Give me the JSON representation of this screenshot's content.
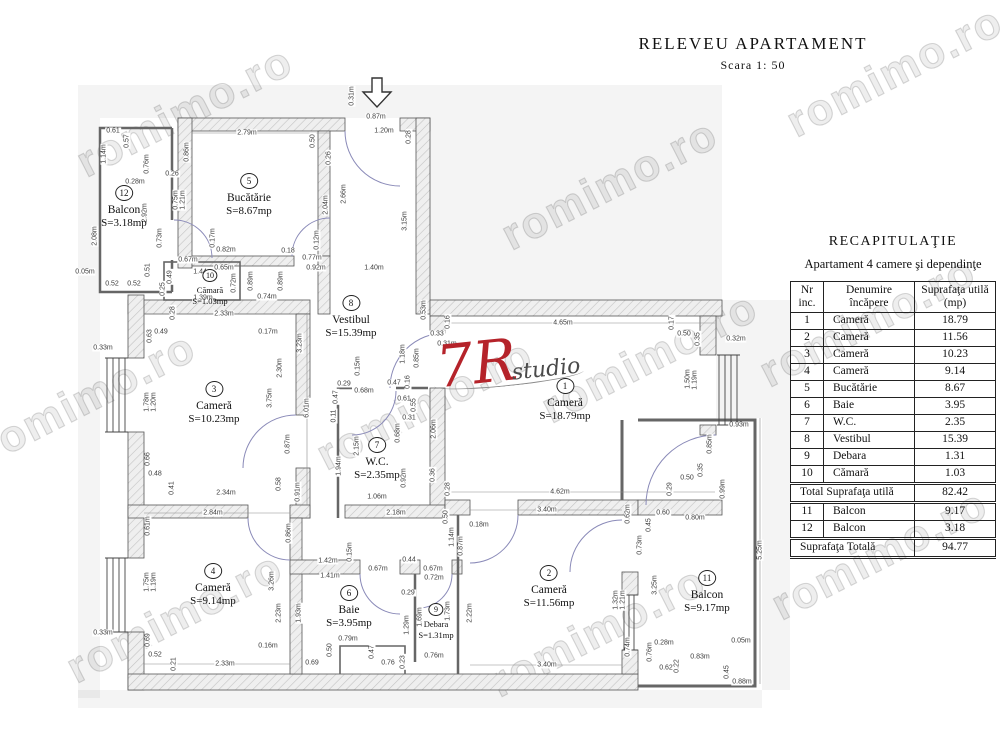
{
  "title": {
    "main": "RELEVEU  APARTAMENT",
    "scale": "Scara  1: 50"
  },
  "logo": {
    "mark": "7R",
    "word": "studio"
  },
  "watermark": {
    "text": "romimo.ro",
    "positions": [
      [
        185,
        112
      ],
      [
        610,
        185
      ],
      [
        895,
        72
      ],
      [
        88,
        398
      ],
      [
        425,
        405
      ],
      [
        650,
        358
      ],
      [
        175,
        618
      ],
      [
        598,
        632
      ],
      [
        880,
        555
      ],
      [
        868,
        322
      ]
    ]
  },
  "recap": {
    "title": "RECAPITULAŢIE",
    "subtitle": "Apartament 4 camere şi dependinţe",
    "columns": [
      "Nr inc.",
      "Denumire încăpere",
      "Suprafaţa utilă (mp)"
    ],
    "rows": [
      {
        "nr": "1",
        "name": "Cameră",
        "area": "18.79"
      },
      {
        "nr": "2",
        "name": "Cameră",
        "area": "11.56"
      },
      {
        "nr": "3",
        "name": "Cameră",
        "area": "10.23"
      },
      {
        "nr": "4",
        "name": "Cameră",
        "area": "9.14"
      },
      {
        "nr": "5",
        "name": "Bucătărie",
        "area": "8.67"
      },
      {
        "nr": "6",
        "name": "Baie",
        "area": "3.95"
      },
      {
        "nr": "7",
        "name": "W.C.",
        "area": "2.35"
      },
      {
        "nr": "8",
        "name": "Vestibul",
        "area": "15.39"
      },
      {
        "nr": "9",
        "name": "Debara",
        "area": "1.31"
      },
      {
        "nr": "10",
        "name": "Cămară",
        "area": "1.03"
      }
    ],
    "total_label": "Total Suprafaţa utilă",
    "total_value": "82.42",
    "balcony_rows": [
      {
        "nr": "11",
        "name": "Balcon",
        "area": "9.17"
      },
      {
        "nr": "12",
        "name": "Balcon",
        "area": "3.18"
      }
    ],
    "grand_label": "Suprafaţa  Totală",
    "grand_value": "94.77"
  },
  "plan": {
    "rooms": [
      {
        "nr": "1",
        "name": "Cameră",
        "area": "S=18.79mp",
        "x": 565,
        "y": 383
      },
      {
        "nr": "2",
        "name": "Cameră",
        "area": "S=11.56mp",
        "x": 549,
        "y": 570
      },
      {
        "nr": "3",
        "name": "Cameră",
        "area": "S=10.23mp",
        "x": 214,
        "y": 386
      },
      {
        "nr": "4",
        "name": "Cameră",
        "area": "S=9.14mp",
        "x": 213,
        "y": 568
      },
      {
        "nr": "5",
        "name": "Bucătărie",
        "area": "S=8.67mp",
        "x": 249,
        "y": 178
      },
      {
        "nr": "6",
        "name": "Baie",
        "area": "S=3.95mp",
        "x": 349,
        "y": 590
      },
      {
        "nr": "7",
        "name": "W.C.",
        "area": "S=2.35mp",
        "x": 377,
        "y": 442
      },
      {
        "nr": "8",
        "name": "Vestibul",
        "area": "S=15.39mp",
        "x": 351,
        "y": 300
      },
      {
        "nr": "9",
        "name": "Debara",
        "area": "S=1.31mp",
        "x": 436,
        "y": 606,
        "s": true
      },
      {
        "nr": "10",
        "name": "Cămară",
        "area": "S=1.03mp",
        "x": 210,
        "y": 272,
        "s": true
      },
      {
        "nr": "11",
        "name": "Balcon",
        "area": "S=9.17mp",
        "x": 707,
        "y": 575
      },
      {
        "nr": "12",
        "name": "Balcon",
        "area": "S=3.18mp",
        "x": 124,
        "y": 190
      }
    ],
    "dimensions": [
      {
        "t": "0.31m",
        "x": 352,
        "y": 96,
        "r": 90
      },
      {
        "t": "0.87m",
        "x": 376,
        "y": 117,
        "r": 0
      },
      {
        "t": "1.20m",
        "x": 384,
        "y": 131,
        "r": 0
      },
      {
        "t": "0.28",
        "x": 409,
        "y": 137,
        "r": 90
      },
      {
        "t": "2.79m",
        "x": 247,
        "y": 133,
        "r": 0
      },
      {
        "t": "0.50",
        "x": 313,
        "y": 141,
        "r": 90
      },
      {
        "t": "0.26",
        "x": 329,
        "y": 158,
        "r": 90
      },
      {
        "t": "0.86m",
        "x": 187,
        "y": 152,
        "r": 90
      },
      {
        "t": "0.61",
        "x": 113,
        "y": 131,
        "r": 0
      },
      {
        "t": "0.57",
        "x": 127,
        "y": 141,
        "r": 90
      },
      {
        "t": "1.14m",
        "x": 104,
        "y": 154,
        "r": 90
      },
      {
        "t": "0.76m",
        "x": 147,
        "y": 164,
        "r": 90
      },
      {
        "t": "0.28m",
        "x": 135,
        "y": 182,
        "r": 0
      },
      {
        "t": "0.26",
        "x": 172,
        "y": 174,
        "r": 0
      },
      {
        "t": "2.92m",
        "x": 145,
        "y": 213,
        "r": 90
      },
      {
        "t": "0.75m",
        "x": 176,
        "y": 200,
        "r": 90
      },
      {
        "t": "1.21m",
        "x": 183,
        "y": 200,
        "r": 90
      },
      {
        "t": "2.66m",
        "x": 344,
        "y": 194,
        "r": 90
      },
      {
        "t": "2.04m",
        "x": 326,
        "y": 205,
        "r": 90
      },
      {
        "t": "3.15m",
        "x": 405,
        "y": 221,
        "r": 90
      },
      {
        "t": "0.12m",
        "x": 317,
        "y": 240,
        "r": 90
      },
      {
        "t": "0.17m",
        "x": 213,
        "y": 238,
        "r": 90
      },
      {
        "t": "0.82m",
        "x": 226,
        "y": 250,
        "r": 0
      },
      {
        "t": "0.18",
        "x": 288,
        "y": 251,
        "r": 0
      },
      {
        "t": "0.77m",
        "x": 312,
        "y": 258,
        "r": 0
      },
      {
        "t": "0.92m",
        "x": 316,
        "y": 268,
        "r": 0
      },
      {
        "t": "0.67m",
        "x": 188,
        "y": 260,
        "r": 0
      },
      {
        "t": "1.44m",
        "x": 203,
        "y": 272,
        "r": 0
      },
      {
        "t": "0.65m",
        "x": 224,
        "y": 268,
        "r": 0
      },
      {
        "t": "0.49",
        "x": 170,
        "y": 277,
        "r": 90
      },
      {
        "t": "0.25",
        "x": 163,
        "y": 289,
        "r": 90
      },
      {
        "t": "0.72m",
        "x": 234,
        "y": 283,
        "r": 90
      },
      {
        "t": "0.89m",
        "x": 251,
        "y": 281,
        "r": 90
      },
      {
        "t": "0.89m",
        "x": 281,
        "y": 281,
        "r": 90
      },
      {
        "t": "1.39m",
        "x": 203,
        "y": 298,
        "r": 0
      },
      {
        "t": "0.74m",
        "x": 267,
        "y": 297,
        "r": 0
      },
      {
        "t": "2.08m",
        "x": 95,
        "y": 236,
        "r": 90
      },
      {
        "t": "0.73m",
        "x": 160,
        "y": 238,
        "r": 90
      },
      {
        "t": "0.51",
        "x": 148,
        "y": 270,
        "r": 90
      },
      {
        "t": "0.52",
        "x": 112,
        "y": 284,
        "r": 0
      },
      {
        "t": "0.52",
        "x": 134,
        "y": 284,
        "r": 0
      },
      {
        "t": "0.05m",
        "x": 85,
        "y": 272,
        "r": 0
      },
      {
        "t": "1.40m",
        "x": 374,
        "y": 268,
        "r": 0
      },
      {
        "t": "0.53m",
        "x": 424,
        "y": 310,
        "r": 90
      },
      {
        "t": "0.15m",
        "x": 358,
        "y": 366,
        "r": 90
      },
      {
        "t": "1.18m",
        "x": 403,
        "y": 354,
        "r": 90
      },
      {
        "t": "0.85m",
        "x": 417,
        "y": 358,
        "r": 90
      },
      {
        "t": "0.29",
        "x": 344,
        "y": 384,
        "r": 0
      },
      {
        "t": "0.47",
        "x": 336,
        "y": 397,
        "r": 90
      },
      {
        "t": "0.68m",
        "x": 364,
        "y": 391,
        "r": 0
      },
      {
        "t": "0.47",
        "x": 394,
        "y": 383,
        "r": 0
      },
      {
        "t": "0.16",
        "x": 408,
        "y": 382,
        "r": 90
      },
      {
        "t": "0.61",
        "x": 404,
        "y": 399,
        "r": 0
      },
      {
        "t": "0.55",
        "x": 414,
        "y": 405,
        "r": 90
      },
      {
        "t": "0.31",
        "x": 409,
        "y": 418,
        "r": 0
      },
      {
        "t": "0.11",
        "x": 334,
        "y": 416,
        "r": 90
      },
      {
        "t": "2.15m",
        "x": 357,
        "y": 446,
        "r": 90
      },
      {
        "t": "1.94m",
        "x": 339,
        "y": 466,
        "r": 90
      },
      {
        "t": "0.68m",
        "x": 398,
        "y": 433,
        "r": 90
      },
      {
        "t": "0.92m",
        "x": 404,
        "y": 478,
        "r": 90
      },
      {
        "t": "1.06m",
        "x": 377,
        "y": 497,
        "r": 0
      },
      {
        "t": "2.18m",
        "x": 396,
        "y": 513,
        "r": 0
      },
      {
        "t": "0.33",
        "x": 437,
        "y": 334,
        "r": 0
      },
      {
        "t": "0.31m",
        "x": 447,
        "y": 344,
        "r": 0
      },
      {
        "t": "2.06m",
        "x": 434,
        "y": 429,
        "r": 90
      },
      {
        "t": "0.36",
        "x": 433,
        "y": 475,
        "r": 90
      },
      {
        "t": "0.28",
        "x": 448,
        "y": 489,
        "r": 90
      },
      {
        "t": "0.33m",
        "x": 103,
        "y": 348,
        "r": 0
      },
      {
        "t": "0.63",
        "x": 150,
        "y": 336,
        "r": 90
      },
      {
        "t": "0.49",
        "x": 161,
        "y": 332,
        "r": 0
      },
      {
        "t": "0.28",
        "x": 173,
        "y": 313,
        "r": 90
      },
      {
        "t": "2.33m",
        "x": 224,
        "y": 314,
        "r": 0
      },
      {
        "t": "0.17m",
        "x": 268,
        "y": 332,
        "r": 0
      },
      {
        "t": "3.23m",
        "x": 300,
        "y": 343,
        "r": 90
      },
      {
        "t": "2.30m",
        "x": 280,
        "y": 368,
        "r": 90
      },
      {
        "t": "3.75m",
        "x": 270,
        "y": 398,
        "r": 90
      },
      {
        "t": "6.01m",
        "x": 307,
        "y": 408,
        "r": 90
      },
      {
        "t": "1.78m",
        "x": 147,
        "y": 402,
        "r": 90
      },
      {
        "t": "1.20m",
        "x": 154,
        "y": 402,
        "r": 90
      },
      {
        "t": "0.66",
        "x": 148,
        "y": 459,
        "r": 90
      },
      {
        "t": "0.48",
        "x": 155,
        "y": 474,
        "r": 0
      },
      {
        "t": "0.41",
        "x": 172,
        "y": 488,
        "r": 90
      },
      {
        "t": "2.34m",
        "x": 226,
        "y": 493,
        "r": 0
      },
      {
        "t": "0.58",
        "x": 279,
        "y": 484,
        "r": 90
      },
      {
        "t": "0.87m",
        "x": 288,
        "y": 444,
        "r": 90
      },
      {
        "t": "0.91m",
        "x": 298,
        "y": 492,
        "r": 90
      },
      {
        "t": "4.65m",
        "x": 563,
        "y": 323,
        "r": 0
      },
      {
        "t": "0.16",
        "x": 448,
        "y": 322,
        "r": 90
      },
      {
        "t": "0.17",
        "x": 672,
        "y": 323,
        "r": 90
      },
      {
        "t": "0.50",
        "x": 684,
        "y": 334,
        "r": 0
      },
      {
        "t": "0.35",
        "x": 698,
        "y": 339,
        "r": 90
      },
      {
        "t": "0.32m",
        "x": 736,
        "y": 339,
        "r": 0
      },
      {
        "t": "1.50m",
        "x": 688,
        "y": 379,
        "r": 90
      },
      {
        "t": "1.19m",
        "x": 695,
        "y": 380,
        "r": 90
      },
      {
        "t": "0.93m",
        "x": 739,
        "y": 425,
        "r": 0
      },
      {
        "t": "0.85m",
        "x": 710,
        "y": 444,
        "r": 90
      },
      {
        "t": "0.50",
        "x": 687,
        "y": 478,
        "r": 0
      },
      {
        "t": "0.35",
        "x": 701,
        "y": 470,
        "r": 90
      },
      {
        "t": "0.99m",
        "x": 723,
        "y": 489,
        "r": 90
      },
      {
        "t": "4.62m",
        "x": 560,
        "y": 492,
        "r": 0
      },
      {
        "t": "0.29",
        "x": 670,
        "y": 489,
        "r": 90
      },
      {
        "t": "2.84m",
        "x": 213,
        "y": 513,
        "r": 0
      },
      {
        "t": "0.61m",
        "x": 148,
        "y": 526,
        "r": 90
      },
      {
        "t": "1.75m",
        "x": 147,
        "y": 582,
        "r": 90
      },
      {
        "t": "1.19m",
        "x": 154,
        "y": 582,
        "r": 90
      },
      {
        "t": "0.69",
        "x": 148,
        "y": 640,
        "r": 90
      },
      {
        "t": "0.52",
        "x": 155,
        "y": 655,
        "r": 0
      },
      {
        "t": "0.33m",
        "x": 103,
        "y": 633,
        "r": 0
      },
      {
        "t": "0.21",
        "x": 174,
        "y": 664,
        "r": 90
      },
      {
        "t": "2.33m",
        "x": 225,
        "y": 664,
        "r": 0
      },
      {
        "t": "3.26m",
        "x": 272,
        "y": 581,
        "r": 90
      },
      {
        "t": "2.23m",
        "x": 279,
        "y": 613,
        "r": 90
      },
      {
        "t": "0.16m",
        "x": 268,
        "y": 646,
        "r": 0
      },
      {
        "t": "0.86m",
        "x": 289,
        "y": 533,
        "r": 90
      },
      {
        "t": "1.42m",
        "x": 328,
        "y": 561,
        "r": 0
      },
      {
        "t": "0.15m",
        "x": 350,
        "y": 552,
        "r": 90
      },
      {
        "t": "1.41m",
        "x": 330,
        "y": 576,
        "r": 0
      },
      {
        "t": "0.44",
        "x": 409,
        "y": 560,
        "r": 0
      },
      {
        "t": "0.67m",
        "x": 378,
        "y": 569,
        "r": 0
      },
      {
        "t": "0.67m",
        "x": 433,
        "y": 569,
        "r": 0
      },
      {
        "t": "0.72m",
        "x": 434,
        "y": 578,
        "r": 0
      },
      {
        "t": "0.29",
        "x": 408,
        "y": 593,
        "r": 0
      },
      {
        "t": "1.93m",
        "x": 299,
        "y": 613,
        "r": 90
      },
      {
        "t": "1.29m",
        "x": 407,
        "y": 625,
        "r": 90
      },
      {
        "t": "1.69m",
        "x": 420,
        "y": 617,
        "r": 90
      },
      {
        "t": "1.73m",
        "x": 448,
        "y": 611,
        "r": 90
      },
      {
        "t": "0.79m",
        "x": 348,
        "y": 639,
        "r": 0
      },
      {
        "t": "0.50",
        "x": 330,
        "y": 650,
        "r": 90
      },
      {
        "t": "0.69",
        "x": 312,
        "y": 663,
        "r": 0
      },
      {
        "t": "0.47",
        "x": 372,
        "y": 652,
        "r": 90
      },
      {
        "t": "0.76",
        "x": 388,
        "y": 663,
        "r": 0
      },
      {
        "t": "0.23",
        "x": 403,
        "y": 662,
        "r": 90
      },
      {
        "t": "0.76m",
        "x": 434,
        "y": 656,
        "r": 0
      },
      {
        "t": "0.50",
        "x": 446,
        "y": 517,
        "r": 90
      },
      {
        "t": "3.40m",
        "x": 547,
        "y": 510,
        "r": 0
      },
      {
        "t": "0.18m",
        "x": 479,
        "y": 525,
        "r": 0
      },
      {
        "t": "1.14m",
        "x": 452,
        "y": 537,
        "r": 90
      },
      {
        "t": "0.87m",
        "x": 461,
        "y": 546,
        "r": 90
      },
      {
        "t": "0.62m",
        "x": 628,
        "y": 514,
        "r": 90
      },
      {
        "t": "0.73m",
        "x": 640,
        "y": 545,
        "r": 90
      },
      {
        "t": "2.22m",
        "x": 470,
        "y": 613,
        "r": 90
      },
      {
        "t": "1.32m",
        "x": 616,
        "y": 600,
        "r": 90
      },
      {
        "t": "1.21m",
        "x": 623,
        "y": 600,
        "r": 90
      },
      {
        "t": "3.25m",
        "x": 655,
        "y": 585,
        "r": 90
      },
      {
        "t": "0.74m",
        "x": 628,
        "y": 647,
        "r": 90
      },
      {
        "t": "3.40m",
        "x": 547,
        "y": 665,
        "r": 0
      },
      {
        "t": "0.28m",
        "x": 664,
        "y": 643,
        "r": 0
      },
      {
        "t": "0.76m",
        "x": 650,
        "y": 652,
        "r": 90
      },
      {
        "t": "0.83m",
        "x": 700,
        "y": 657,
        "r": 0
      },
      {
        "t": "0.62",
        "x": 666,
        "y": 668,
        "r": 0
      },
      {
        "t": "0.22",
        "x": 677,
        "y": 666,
        "r": 90
      },
      {
        "t": "0.45",
        "x": 727,
        "y": 672,
        "r": 90
      },
      {
        "t": "0.88m",
        "x": 742,
        "y": 682,
        "r": 0
      },
      {
        "t": "0.60",
        "x": 663,
        "y": 513,
        "r": 0
      },
      {
        "t": "0.80m",
        "x": 695,
        "y": 518,
        "r": 0
      },
      {
        "t": "0.45",
        "x": 649,
        "y": 525,
        "r": 90
      },
      {
        "t": "5.25m",
        "x": 760,
        "y": 550,
        "r": 90
      },
      {
        "t": "0.05m",
        "x": 741,
        "y": 641,
        "r": 0
      }
    ]
  }
}
